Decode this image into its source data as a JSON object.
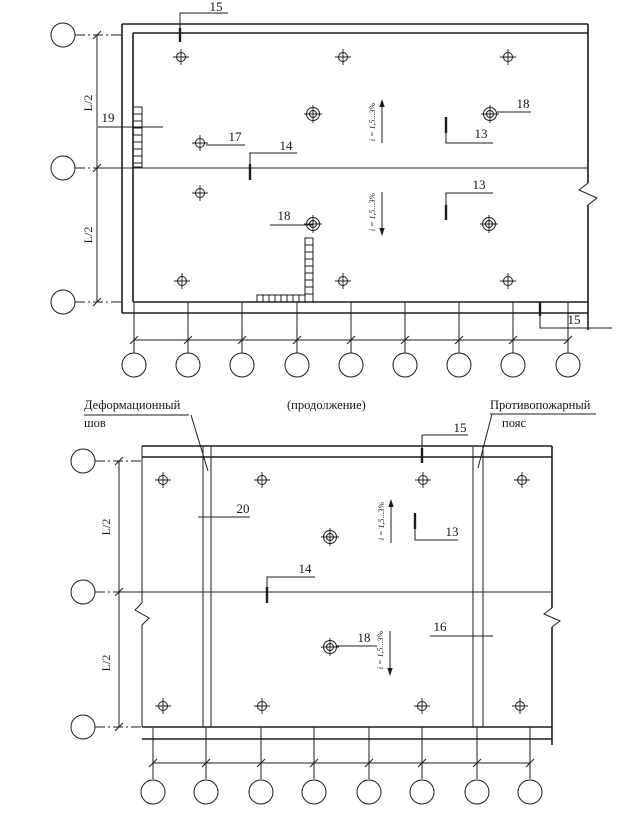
{
  "top_plan": {
    "callouts": {
      "parapet_top": "15",
      "wall_ladder": "19",
      "funnel": "17",
      "ridge": "14",
      "drain_upper": "18",
      "slope_upper": "13",
      "slope_lower": "13",
      "drain_lower": "18",
      "parapet_corner": "15"
    },
    "dims": {
      "half_span_upper": "L/2",
      "half_span_lower": "L/2"
    },
    "slopes": {
      "upper": "i = 1,5...3%",
      "lower": "i = 1,5...3%"
    }
  },
  "bottom_plan": {
    "labels": {
      "deformation_joint_line1": "Деформационный",
      "deformation_joint_line2": "шов",
      "continuation": "(продолжение)",
      "fire_belt_line1": "Противопожарный",
      "fire_belt_line2": "пояс"
    },
    "callouts": {
      "parapet_top": "15",
      "deformation_joint": "20",
      "slope": "13",
      "ridge": "14",
      "drain": "18",
      "fire_belt": "16"
    },
    "dims": {
      "half_span_upper": "L/2",
      "half_span_lower": "L/2"
    },
    "slopes": {
      "upper": "i = 1,5...3%",
      "lower": "i = 1,5...3%"
    }
  }
}
